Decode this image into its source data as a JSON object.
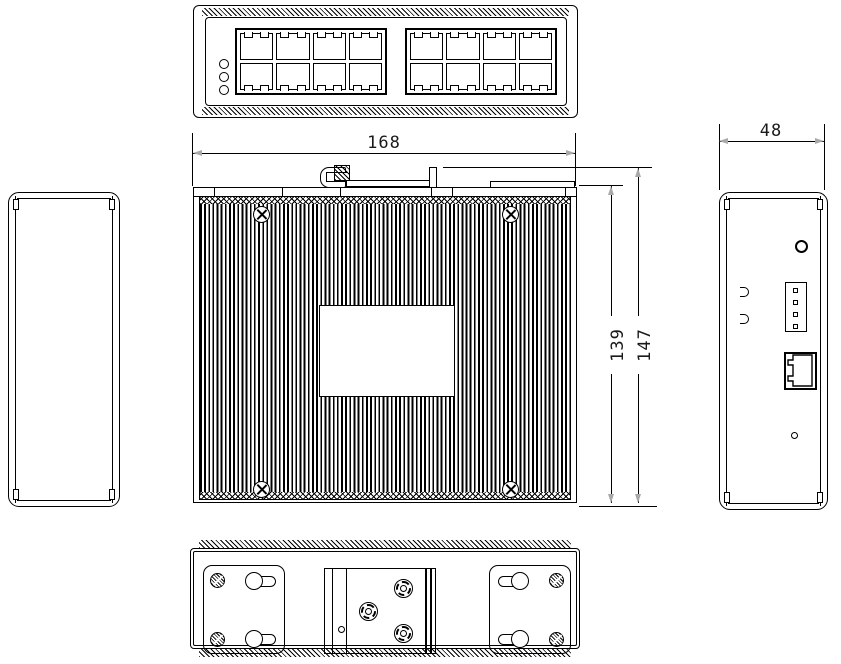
{
  "dimensions": {
    "width_label": "168",
    "depth_label": "48",
    "body_height_label": "139",
    "total_height_label": "147"
  },
  "colors": {
    "line": "#000000",
    "background": "#ffffff",
    "arrow": "#a9a9a9"
  },
  "top_view": {
    "port_groups": 2,
    "port_cols": 4,
    "port_rows": 2,
    "led_count": 3
  },
  "front_view": {
    "corner_screws": 4
  },
  "right_view": {
    "terminal_pins": 4
  },
  "bottom_view": {
    "mount_plates": 2,
    "keyholes_per_plate": 2,
    "bracket_screws": 3
  }
}
